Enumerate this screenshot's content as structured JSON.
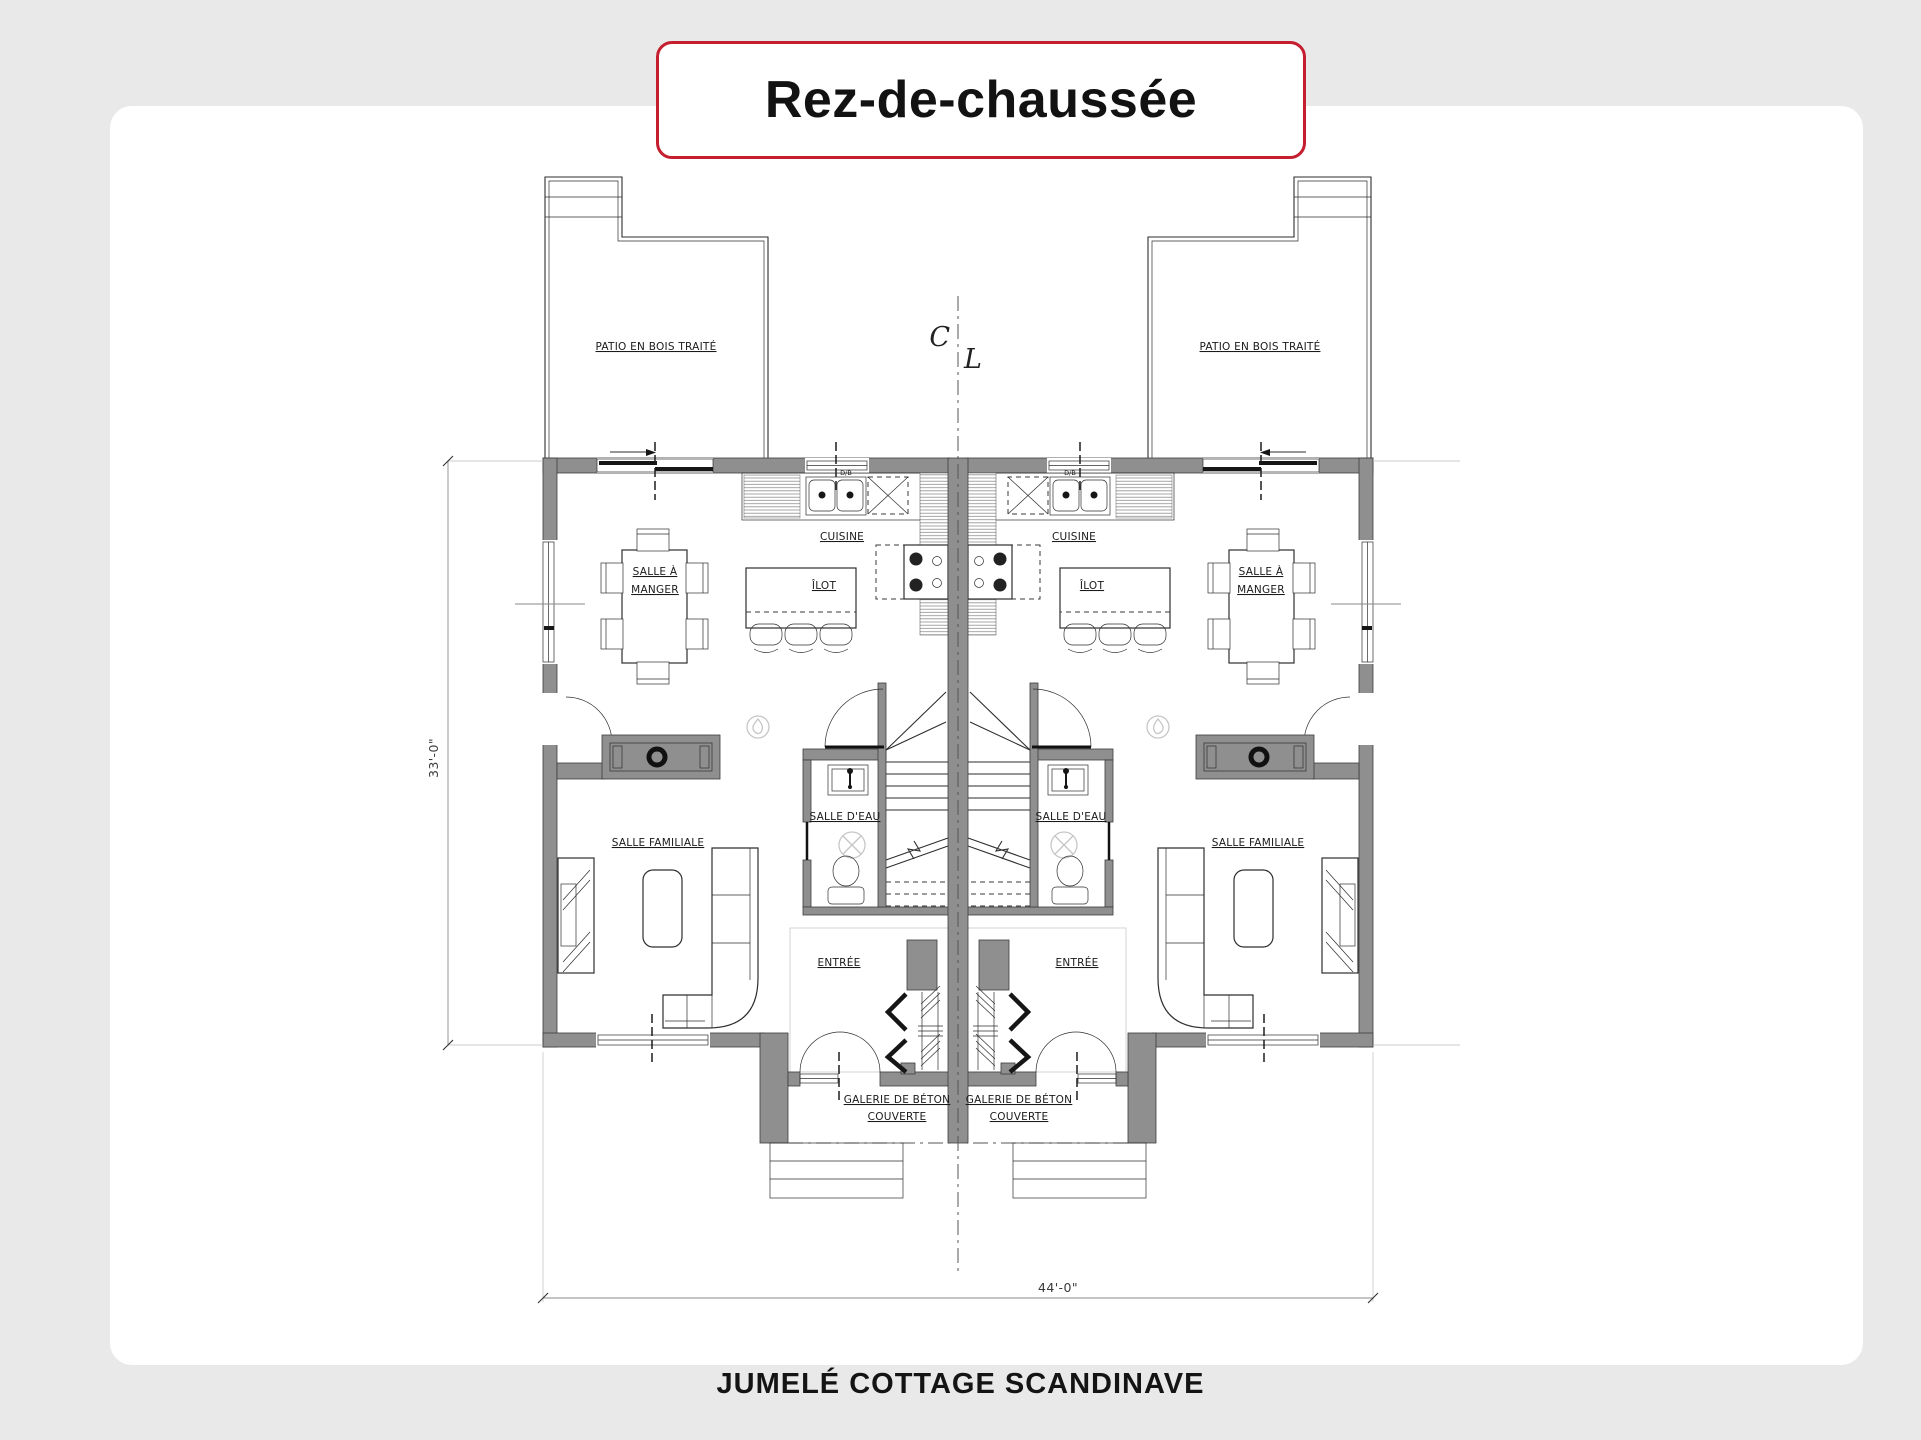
{
  "page": {
    "background": "#e9e9e9",
    "accent_red": "#c41e2f",
    "card_color": "#ffffff",
    "title": "Rez-de-chaussée",
    "caption": "JUMELÉ COTTAGE SCANDINAVE"
  },
  "plan": {
    "rooms": {
      "patio": "PATIO EN BOIS TRAITÉ",
      "cuisine": "CUISINE",
      "ilot": "ÎLOT",
      "salle_a_manger_line1": "SALLE À",
      "salle_a_manger_line2": "MANGER",
      "salle_familiale": "SALLE FAMILIALE",
      "salle_deau": "SALLE D'EAU",
      "entree": "ENTRÉE",
      "galerie_line1": "GALERIE DE BÉTON",
      "galerie_line2": "COUVERTE"
    },
    "fixtures": {
      "sink_tag": "D/B"
    },
    "centerline": {
      "c": "C",
      "l": "L"
    },
    "dimensions": {
      "overall_width": "44'-0\"",
      "overall_depth": "33'-0\""
    }
  }
}
